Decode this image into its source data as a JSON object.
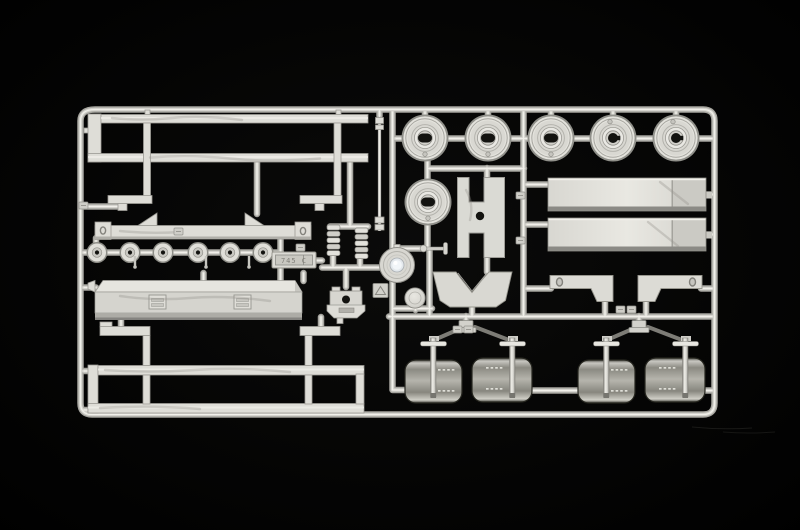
{
  "photo": {
    "subject": "Injection-molded light gray polystyrene model kit sprue with truck trailer parts photographed on a black background",
    "background_color": "#000000",
    "plastic_color": "#d9d8d3",
    "mold_plate_text": "745 C",
    "part_summary": {
      "wheel_halves": 6,
      "small_rollers": 6,
      "mudguards": 4,
      "leaf_springs": 2,
      "ramp_plates": 2,
      "ladder_frames": 2,
      "storage_box": 1,
      "brackets": 3
    }
  },
  "sprue_layout": {
    "wheels": [
      {
        "cx": 425,
        "cy": 138,
        "hole": "oval"
      },
      {
        "cx": 488,
        "cy": 138,
        "hole": "oval"
      },
      {
        "cx": 551,
        "cy": 138,
        "hole": "oval"
      },
      {
        "cx": 613,
        "cy": 138,
        "hole": "round"
      },
      {
        "cx": 676,
        "cy": 138,
        "hole": "round"
      },
      {
        "cx": 428,
        "cy": 202,
        "hole": "oval"
      }
    ],
    "rollers": {
      "cy": 252.5,
      "cx": [
        97,
        130,
        163,
        198,
        230,
        263
      ]
    },
    "roller_pins": [
      135,
      206,
      249
    ],
    "fenders": [
      {
        "x": 405,
        "y": 360,
        "w": 57,
        "h": 43
      },
      {
        "x": 472,
        "y": 358,
        "w": 60,
        "h": 44
      },
      {
        "x": 578,
        "y": 360,
        "w": 57,
        "h": 43
      },
      {
        "x": 645,
        "y": 358,
        "w": 60,
        "h": 44
      }
    ],
    "leaf_springs": [
      {
        "x": 327,
        "y": 225
      },
      {
        "x": 355,
        "y": 228
      }
    ],
    "mold_tags": [
      [
        79,
        202
      ],
      [
        174,
        228
      ],
      [
        296,
        244
      ],
      [
        516,
        192
      ],
      [
        516,
        237
      ],
      [
        453,
        326
      ],
      [
        464,
        326
      ],
      [
        616,
        306
      ],
      [
        627,
        306
      ]
    ]
  }
}
